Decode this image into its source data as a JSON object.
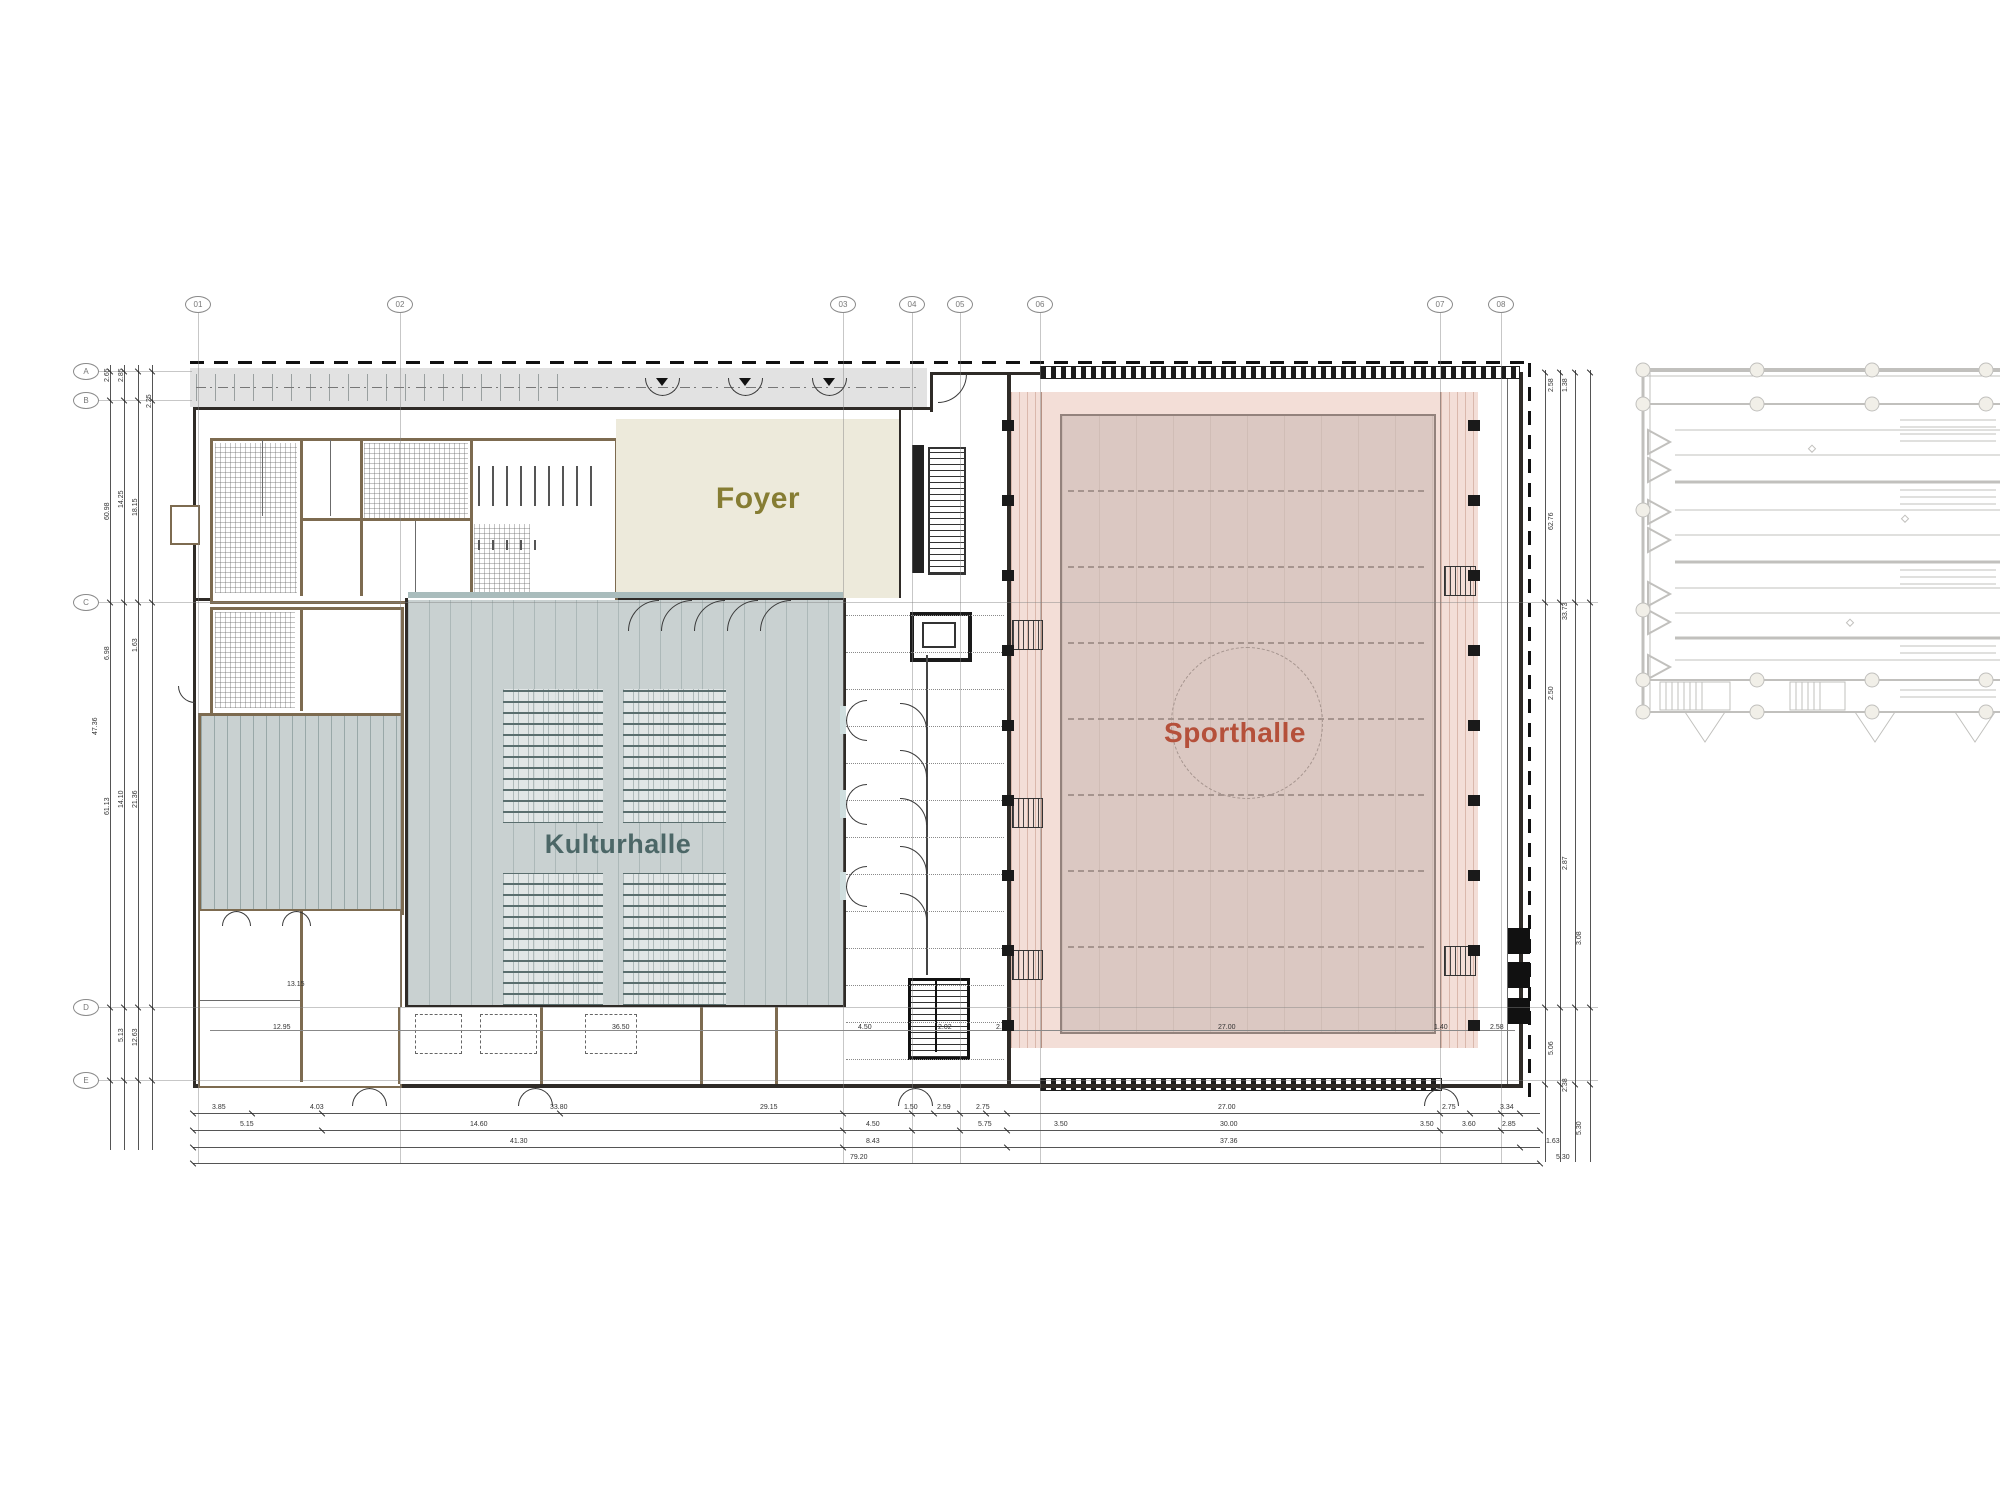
{
  "title_labels": {
    "foyer": "Foyer",
    "kulturhalle": "Kulturhalle",
    "sporthalle": "Sporthalle"
  },
  "grid_axes": {
    "columns": [
      {
        "label": "01",
        "x": 198
      },
      {
        "label": "02",
        "x": 400
      },
      {
        "label": "03",
        "x": 843
      },
      {
        "label": "04",
        "x": 912
      },
      {
        "label": "05",
        "x": 960
      },
      {
        "label": "06",
        "x": 1040
      },
      {
        "label": "07",
        "x": 1440
      },
      {
        "label": "08",
        "x": 1501
      }
    ],
    "rows": [
      {
        "label": "A",
        "y": 371
      },
      {
        "label": "B",
        "y": 400
      },
      {
        "label": "C",
        "y": 602
      },
      {
        "label": "D",
        "y": 1007
      },
      {
        "label": "E",
        "y": 1080
      }
    ]
  },
  "colors": {
    "foyer_fill": "#edeadb",
    "foyer_text": "#867d33",
    "kultur_fill": "#c9d1d1",
    "kultur_text": "#4c6767",
    "sport_fill": "#f3ded7",
    "court_fill": "#dbc8c2",
    "sport_text": "#b5503a",
    "wall": "#2f2b27",
    "wall_brown": "#7d6b50",
    "canopy": "#e2e2e2",
    "ghost": "#8f8e88"
  },
  "dimensions": {
    "bottom_rows": [
      {
        "y": 1113,
        "items": [
          {
            "t": "3.85",
            "x": 222
          },
          {
            "t": "4.03",
            "x": 320
          },
          {
            "t": "33.80",
            "x": 560
          },
          {
            "t": "29.15",
            "x": 770
          },
          {
            "t": "1.50",
            "x": 914
          },
          {
            "t": "2.59",
            "x": 947
          },
          {
            "t": "2.75",
            "x": 986
          },
          {
            "t": "27.00",
            "x": 1228
          },
          {
            "t": "2.75",
            "x": 1452
          },
          {
            "t": "3.34",
            "x": 1510
          }
        ]
      },
      {
        "y": 1130,
        "items": [
          {
            "t": "5.15",
            "x": 250
          },
          {
            "t": "14.60",
            "x": 480
          },
          {
            "t": "4.50",
            "x": 876
          },
          {
            "t": "5.75",
            "x": 988
          },
          {
            "t": "3.50",
            "x": 1064
          },
          {
            "t": "30.00",
            "x": 1230
          },
          {
            "t": "3.50",
            "x": 1430
          },
          {
            "t": "3.60",
            "x": 1472
          },
          {
            "t": "2.85",
            "x": 1512
          }
        ]
      },
      {
        "y": 1147,
        "items": [
          {
            "t": "41.30",
            "x": 520
          },
          {
            "t": "8.43",
            "x": 876
          },
          {
            "t": "37.36",
            "x": 1230
          },
          {
            "t": "1.63",
            "x": 1556
          }
        ]
      },
      {
        "y": 1163,
        "items": [
          {
            "t": "79.20",
            "x": 860
          },
          {
            "t": "5.30",
            "x": 1566
          }
        ]
      }
    ],
    "left_chain": [
      {
        "t": "2.65",
        "x": 104,
        "y": 382
      },
      {
        "t": "2.85",
        "x": 118,
        "y": 382
      },
      {
        "t": "2.25",
        "x": 146,
        "y": 408
      },
      {
        "t": "60.98",
        "x": 104,
        "y": 520
      },
      {
        "t": "14.25",
        "x": 118,
        "y": 508
      },
      {
        "t": "18.15",
        "x": 132,
        "y": 516
      },
      {
        "t": "6.98",
        "x": 104,
        "y": 660
      },
      {
        "t": "1.63",
        "x": 132,
        "y": 652
      },
      {
        "t": "47.36",
        "x": 92,
        "y": 735
      },
      {
        "t": "14.10",
        "x": 118,
        "y": 808
      },
      {
        "t": "21.36",
        "x": 132,
        "y": 808
      },
      {
        "t": "61.13",
        "x": 104,
        "y": 815
      },
      {
        "t": "5.13",
        "x": 118,
        "y": 1042
      },
      {
        "t": "12.63",
        "x": 132,
        "y": 1046
      }
    ],
    "right_chain": [
      {
        "t": "2.58",
        "x": 1548,
        "y": 392
      },
      {
        "t": "1.38",
        "x": 1562,
        "y": 392
      },
      {
        "t": "62.76",
        "x": 1548,
        "y": 530
      },
      {
        "t": "33.73",
        "x": 1562,
        "y": 620
      },
      {
        "t": "2.50",
        "x": 1548,
        "y": 700
      },
      {
        "t": "2.87",
        "x": 1562,
        "y": 870
      },
      {
        "t": "3.08",
        "x": 1576,
        "y": 945
      },
      {
        "t": "5.06",
        "x": 1548,
        "y": 1055
      },
      {
        "t": "2.38",
        "x": 1562,
        "y": 1092
      },
      {
        "t": "5.30",
        "x": 1576,
        "y": 1135
      }
    ],
    "interior": [
      {
        "t": "13.15",
        "x": 297,
        "y": 981
      },
      {
        "t": "12.95",
        "x": 283,
        "y": 1024
      },
      {
        "t": "36.50",
        "x": 622,
        "y": 1024
      },
      {
        "t": "4.50",
        "x": 868,
        "y": 1024
      },
      {
        "t": "2.02",
        "x": 948,
        "y": 1024
      },
      {
        "t": "2.40",
        "x": 1006,
        "y": 1024
      },
      {
        "t": "27.00",
        "x": 1228,
        "y": 1024
      },
      {
        "t": "1.40",
        "x": 1444,
        "y": 1024
      },
      {
        "t": "2.58",
        "x": 1500,
        "y": 1024
      }
    ]
  }
}
